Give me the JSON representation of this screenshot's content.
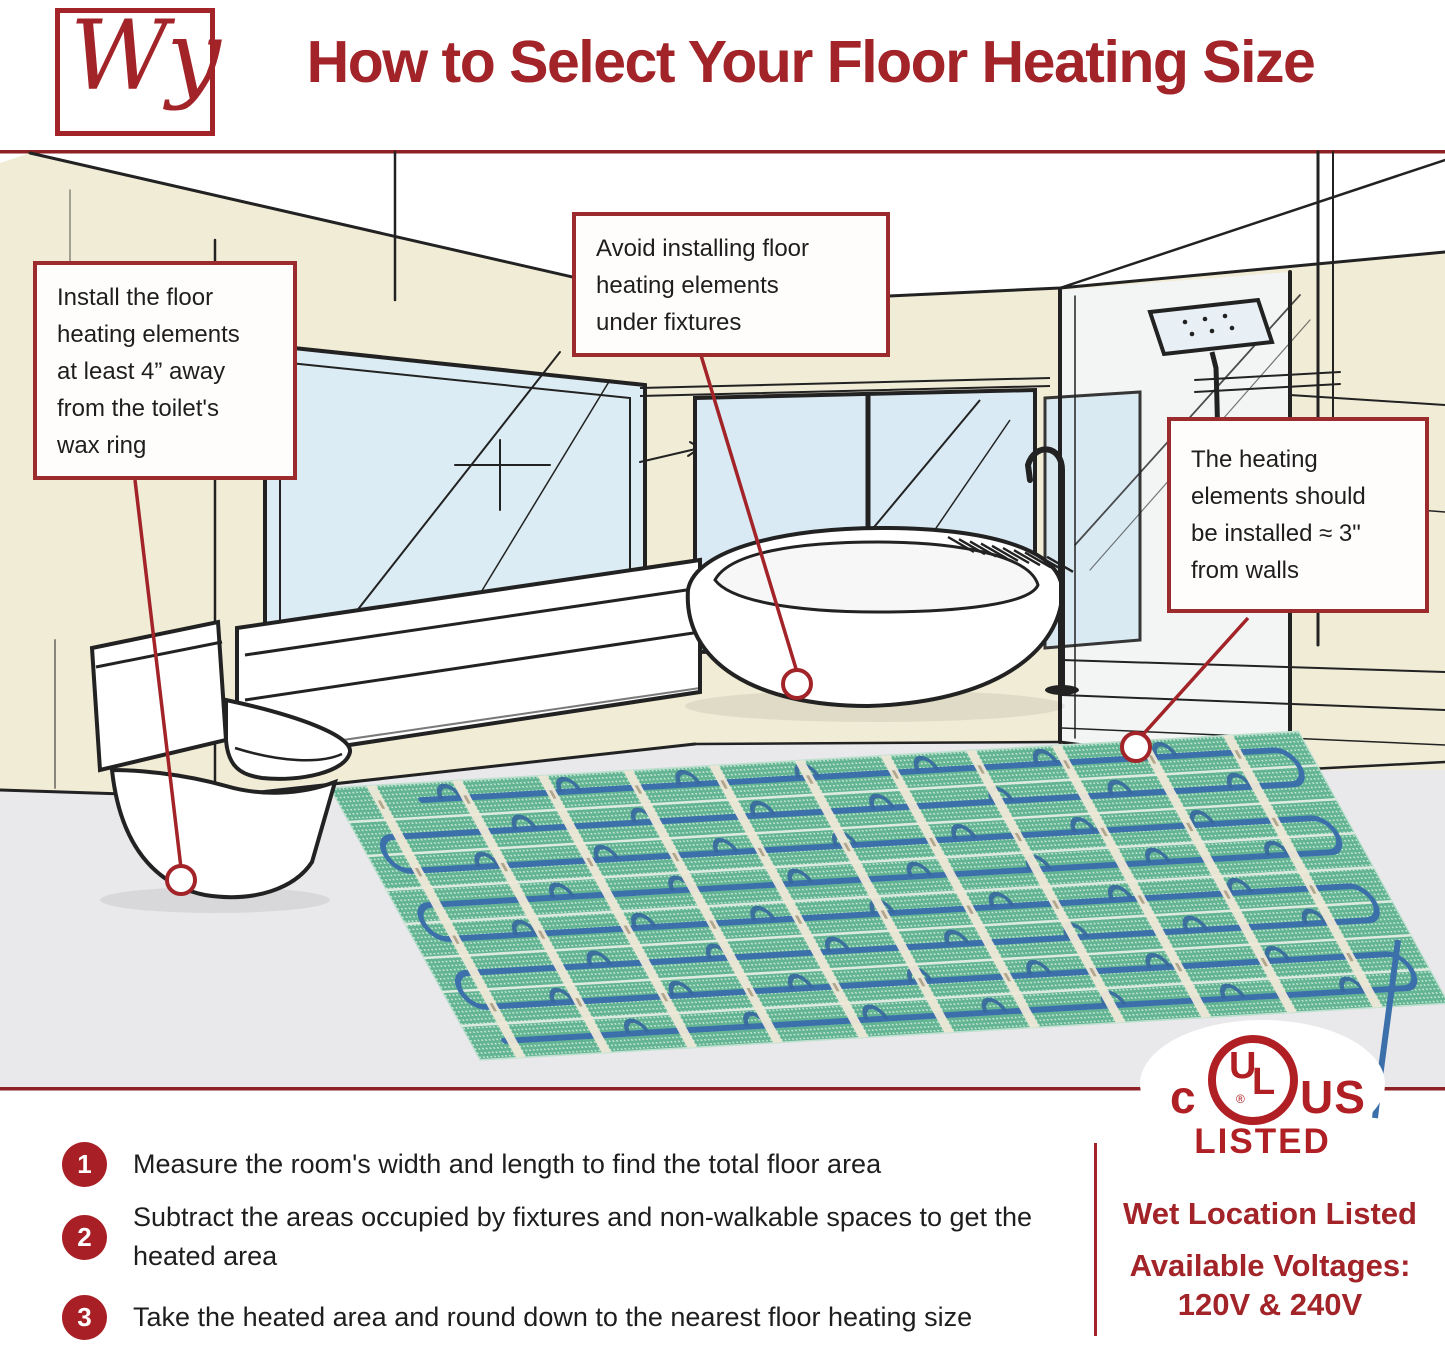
{
  "header": {
    "logo_text": "Wy",
    "title": "How to Select Your Floor Heating Size"
  },
  "illustration": {
    "callouts": [
      {
        "lines": [
          "Install the floor",
          "heating elements",
          "at least 4” away",
          "from the toilet's",
          "wax ring"
        ]
      },
      {
        "lines": [
          "Avoid installing floor",
          "heating elements",
          "under fixtures"
        ]
      },
      {
        "lines": [
          "The heating",
          "elements should",
          "be installed ≈ 3\"",
          "from walls"
        ]
      }
    ]
  },
  "steps": [
    {
      "number": "1",
      "text": "Measure the room's width and length to find the total floor area"
    },
    {
      "number": "2",
      "text": "Subtract the areas occupied by fixtures and non-walkable spaces to get the heated area"
    },
    {
      "number": "3",
      "text": "Take the heated area and round down to the nearest floor heating size"
    }
  ],
  "certification": {
    "c": "c",
    "ul": "UL",
    "registered": "®",
    "us": "US",
    "listed": "LISTED",
    "wet_location": "Wet Location Listed",
    "voltages_label": "Available Voltages:",
    "voltages_value": "120V & 240V"
  },
  "colors": {
    "brand_red": "#a22328",
    "ul_red": "#b01f24",
    "callout_border": "#9c2b2d",
    "text_dark": "#1e1e1e",
    "wall_cream": "#f1ecd6",
    "window_blue": "#d9eaf4",
    "floor_gray": "#e9e9ec",
    "mat_green": "#62b493",
    "wire_blue": "#3c70ab"
  }
}
